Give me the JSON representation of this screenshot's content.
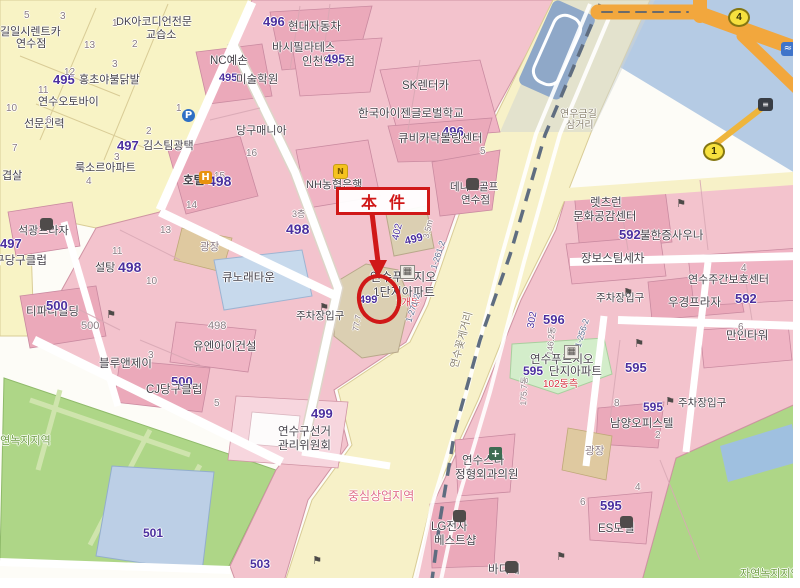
{
  "annotation": {
    "label": "本件"
  },
  "palette": {
    "purple": "#4b2f9e",
    "dark": "#46424a",
    "gray": "#8a7b82",
    "red": "#d83040",
    "zone": "#e0708a",
    "green": "#6f9c45",
    "road": "#8a8270",
    "code": "#5a6b8c",
    "annotation_red": "#d01818",
    "parcel_pink": "#f3c3cd",
    "parcel_yellow": "#f8f3c5",
    "road_yellow": "#f7f1c8",
    "water_blue": "#b5cbe4",
    "park_green": "#aed687",
    "orange_road": "#f2a73d"
  },
  "labels": [
    {
      "t": "길일시렌트카",
      "x": 0,
      "y": 27,
      "s": 11,
      "c": "dark"
    },
    {
      "t": "연수점",
      "x": 16,
      "y": 39,
      "s": 11,
      "c": "dark"
    },
    {
      "t": "DK아코디언전문",
      "x": 116,
      "y": 17,
      "s": 11,
      "c": "dark"
    },
    {
      "t": "교습소",
      "x": 146,
      "y": 30,
      "s": 11,
      "c": "dark"
    },
    {
      "t": "495",
      "x": 53,
      "y": 73,
      "s": 13,
      "c": "purple",
      "b": true
    },
    {
      "t": "홍초야불닭발",
      "x": 79,
      "y": 75,
      "s": 11,
      "c": "dark"
    },
    {
      "t": "연수오토바이",
      "x": 38,
      "y": 97,
      "s": 11,
      "c": "dark"
    },
    {
      "t": "선문전력",
      "x": 24,
      "y": 119,
      "s": 11,
      "c": "dark"
    },
    {
      "t": "겹살",
      "x": 2,
      "y": 171,
      "s": 11,
      "c": "dark"
    },
    {
      "t": "5",
      "x": 24,
      "y": 11,
      "s": 10,
      "c": "gray"
    },
    {
      "t": "3",
      "x": 60,
      "y": 12,
      "s": 10,
      "c": "gray"
    },
    {
      "t": "1",
      "x": 112,
      "y": 19,
      "s": 10,
      "c": "gray"
    },
    {
      "t": "13",
      "x": 84,
      "y": 41,
      "s": 10,
      "c": "gray"
    },
    {
      "t": "2",
      "x": 132,
      "y": 40,
      "s": 10,
      "c": "gray"
    },
    {
      "t": "3",
      "x": 112,
      "y": 60,
      "s": 10,
      "c": "gray"
    },
    {
      "t": "12",
      "x": 64,
      "y": 68,
      "s": 10,
      "c": "gray"
    },
    {
      "t": "11",
      "x": 38,
      "y": 86,
      "s": 10,
      "c": "gray"
    },
    {
      "t": "10",
      "x": 6,
      "y": 104,
      "s": 10,
      "c": "gray"
    },
    {
      "t": "6",
      "x": 46,
      "y": 116,
      "s": 10,
      "c": "gray"
    },
    {
      "t": "7",
      "x": 12,
      "y": 144,
      "s": 10,
      "c": "gray"
    },
    {
      "t": "496",
      "x": 263,
      "y": 15,
      "s": 13,
      "c": "purple",
      "b": true
    },
    {
      "t": "현대자동차",
      "x": 288,
      "y": 22,
      "s": 11.5,
      "c": "dark"
    },
    {
      "t": "바시필라테스",
      "x": 272,
      "y": 43,
      "s": 11.5,
      "c": "dark"
    },
    {
      "t": "인천연수점",
      "x": 302,
      "y": 57,
      "s": 11.5,
      "c": "dark"
    },
    {
      "t": "495",
      "x": 325,
      "y": 53,
      "s": 12,
      "c": "purple",
      "b": true
    },
    {
      "t": "NC예손",
      "x": 210,
      "y": 56,
      "s": 11.5,
      "c": "dark"
    },
    {
      "t": "495",
      "x": 219,
      "y": 73,
      "s": 11,
      "c": "purple",
      "b": true
    },
    {
      "t": "미술학원",
      "x": 236,
      "y": 75,
      "s": 11.5,
      "c": "dark"
    },
    {
      "t": "SK렌터카",
      "x": 402,
      "y": 81,
      "s": 11.5,
      "c": "dark"
    },
    {
      "t": "한국아이젠글로벌학교",
      "x": 358,
      "y": 109,
      "s": 11.5,
      "c": "dark"
    },
    {
      "t": "496",
      "x": 442,
      "y": 125,
      "s": 13,
      "c": "purple",
      "b": true
    },
    {
      "t": "큐비카락볼링센터",
      "x": 398,
      "y": 134,
      "s": 11.5,
      "c": "dark"
    },
    {
      "t": "5",
      "x": 480,
      "y": 147,
      "s": 10,
      "c": "gray"
    },
    {
      "t": "당구매니아",
      "x": 236,
      "y": 126,
      "s": 11,
      "c": "dark"
    },
    {
      "t": "16",
      "x": 246,
      "y": 149,
      "s": 10,
      "c": "gray"
    },
    {
      "t": "15",
      "x": 214,
      "y": 172,
      "s": 10,
      "c": "gray"
    },
    {
      "t": "호텔",
      "x": 183,
      "y": 176,
      "s": 11.5,
      "c": "dark",
      "b": true
    },
    {
      "t": "498",
      "x": 208,
      "y": 174,
      "s": 14,
      "c": "purple",
      "b": true
    },
    {
      "t": "497",
      "x": 117,
      "y": 139,
      "s": 13,
      "c": "purple",
      "b": true
    },
    {
      "t": "김스팀광택",
      "x": 143,
      "y": 141,
      "s": 11,
      "c": "dark"
    },
    {
      "t": "룩소르아파트",
      "x": 75,
      "y": 163,
      "s": 11,
      "c": "dark"
    },
    {
      "t": "1",
      "x": 176,
      "y": 104,
      "s": 10,
      "c": "gray"
    },
    {
      "t": "2",
      "x": 146,
      "y": 127,
      "s": 10,
      "c": "gray"
    },
    {
      "t": "3",
      "x": 114,
      "y": 153,
      "s": 10,
      "c": "gray"
    },
    {
      "t": "4",
      "x": 86,
      "y": 177,
      "s": 10,
      "c": "gray"
    },
    {
      "t": "NH농협은행",
      "x": 306,
      "y": 180,
      "s": 11,
      "c": "dark"
    },
    {
      "t": "데니스골프",
      "x": 450,
      "y": 182,
      "s": 10.5,
      "c": "dark"
    },
    {
      "t": "연수점",
      "x": 461,
      "y": 195,
      "s": 10.5,
      "c": "dark"
    },
    {
      "t": "3층",
      "x": 292,
      "y": 210,
      "s": 9,
      "c": "gray"
    },
    {
      "t": "498",
      "x": 286,
      "y": 222,
      "s": 14,
      "c": "purple",
      "b": true
    },
    {
      "t": "광장",
      "x": 200,
      "y": 242,
      "s": 10.5,
      "c": "gray"
    },
    {
      "t": "큐노래타운",
      "x": 222,
      "y": 273,
      "s": 11.5,
      "c": "dark"
    },
    {
      "t": "주차장입구",
      "x": 296,
      "y": 311,
      "s": 10.5,
      "c": "dark"
    },
    {
      "t": "연수푸르지오",
      "x": 370,
      "y": 271,
      "s": 12,
      "c": "dark"
    },
    {
      "t": "1단지아파트",
      "x": 373,
      "y": 286,
      "s": 12,
      "c": "dark"
    },
    {
      "t": "1개동",
      "x": 396,
      "y": 299,
      "s": 10,
      "c": "red"
    },
    {
      "t": "499",
      "x": 359,
      "y": 295,
      "s": 11,
      "c": "purple",
      "b": true
    },
    {
      "t": "77.7",
      "x": 357,
      "y": 323,
      "s": 8.5,
      "c": "gray",
      "r": -80
    },
    {
      "t": "402",
      "x": 398,
      "y": 232,
      "s": 10,
      "c": "purple",
      "r": -77
    },
    {
      "t": "499",
      "x": 414,
      "y": 240,
      "s": 11,
      "c": "purple",
      "b": true,
      "r": -15
    },
    {
      "t": "3.5m",
      "x": 428,
      "y": 229,
      "s": 8.5,
      "c": "gray",
      "r": -77
    },
    {
      "t": "1-261-2",
      "x": 438,
      "y": 255,
      "s": 8.5,
      "c": "code",
      "r": -72
    },
    {
      "t": "1-271-2",
      "x": 413,
      "y": 308,
      "s": 8.5,
      "c": "code",
      "r": -72
    },
    {
      "t": "연수꽃게거리",
      "x": 462,
      "y": 340,
      "s": 10.5,
      "c": "road",
      "r": -75
    },
    {
      "t": "연우금길",
      "x": 560,
      "y": 110,
      "s": 10,
      "c": "road"
    },
    {
      "t": "삼거리",
      "x": 566,
      "y": 121,
      "s": 10,
      "c": "road"
    },
    {
      "t": "석광프라자",
      "x": 18,
      "y": 226,
      "s": 11,
      "c": "dark"
    },
    {
      "t": "497",
      "x": 0,
      "y": 237,
      "s": 13,
      "c": "purple",
      "b": true
    },
    {
      "t": "구당구클럽",
      "x": -6,
      "y": 256,
      "s": 11.5,
      "c": "dark"
    },
    {
      "t": "설탕",
      "x": 95,
      "y": 263,
      "s": 11,
      "c": "dark"
    },
    {
      "t": "498",
      "x": 118,
      "y": 260,
      "s": 14,
      "c": "purple",
      "b": true
    },
    {
      "t": "11",
      "x": 112,
      "y": 247,
      "s": 10,
      "c": "gray"
    },
    {
      "t": "10",
      "x": 146,
      "y": 277,
      "s": 10,
      "c": "gray"
    },
    {
      "t": "13",
      "x": 160,
      "y": 226,
      "s": 10,
      "c": "gray"
    },
    {
      "t": "14",
      "x": 186,
      "y": 201,
      "s": 10,
      "c": "gray"
    },
    {
      "t": "티파니빌딩",
      "x": 26,
      "y": 307,
      "s": 11.5,
      "c": "dark"
    },
    {
      "t": "500",
      "x": 46,
      "y": 299,
      "s": 13,
      "c": "purple",
      "b": true
    },
    {
      "t": "500",
      "x": 81,
      "y": 321,
      "s": 11,
      "c": "gray"
    },
    {
      "t": "498",
      "x": 208,
      "y": 321,
      "s": 11,
      "c": "gray"
    },
    {
      "t": "유엔아이건설",
      "x": 193,
      "y": 342,
      "s": 11.5,
      "c": "dark"
    },
    {
      "t": "블루앤제이",
      "x": 99,
      "y": 359,
      "s": 11.5,
      "c": "dark"
    },
    {
      "t": "3",
      "x": 148,
      "y": 351,
      "s": 10,
      "c": "gray"
    },
    {
      "t": "500",
      "x": 171,
      "y": 375,
      "s": 13,
      "c": "purple",
      "b": true
    },
    {
      "t": "CJ당구클럽",
      "x": 146,
      "y": 385,
      "s": 11.5,
      "c": "dark"
    },
    {
      "t": "5",
      "x": 214,
      "y": 399,
      "s": 10,
      "c": "gray"
    },
    {
      "t": "자연녹지지역",
      "x": -10,
      "y": 436,
      "s": 11,
      "c": "green"
    },
    {
      "t": "501",
      "x": 143,
      "y": 527,
      "s": 12,
      "c": "purple",
      "b": true
    },
    {
      "t": "503",
      "x": 250,
      "y": 558,
      "s": 12,
      "c": "purple",
      "b": true
    },
    {
      "t": "499",
      "x": 311,
      "y": 407,
      "s": 13,
      "c": "purple",
      "b": true
    },
    {
      "t": "연수구선거",
      "x": 278,
      "y": 427,
      "s": 11.5,
      "c": "dark"
    },
    {
      "t": "관리위원회",
      "x": 278,
      "y": 441,
      "s": 11.5,
      "c": "dark"
    },
    {
      "t": "중심상업지역",
      "x": 348,
      "y": 490,
      "s": 12,
      "c": "zone"
    },
    {
      "t": "렛츠런",
      "x": 590,
      "y": 198,
      "s": 11.5,
      "c": "dark"
    },
    {
      "t": "문화공감센터",
      "x": 573,
      "y": 212,
      "s": 11.5,
      "c": "dark"
    },
    {
      "t": "592",
      "x": 619,
      "y": 228,
      "s": 13,
      "c": "purple",
      "b": true
    },
    {
      "t": "불한증사우나",
      "x": 640,
      "y": 231,
      "s": 11.5,
      "c": "dark"
    },
    {
      "t": "장보스팀세차",
      "x": 581,
      "y": 254,
      "s": 11.5,
      "c": "dark"
    },
    {
      "t": "주차장입구",
      "x": 596,
      "y": 293,
      "s": 10.5,
      "c": "dark"
    },
    {
      "t": "연수주간보호센터",
      "x": 688,
      "y": 275,
      "s": 11,
      "c": "dark"
    },
    {
      "t": "4",
      "x": 741,
      "y": 264,
      "s": 10,
      "c": "gray"
    },
    {
      "t": "592",
      "x": 735,
      "y": 292,
      "s": 13,
      "c": "purple",
      "b": true
    },
    {
      "t": "우경프라자",
      "x": 668,
      "y": 298,
      "s": 11.5,
      "c": "dark"
    },
    {
      "t": "만인타워",
      "x": 726,
      "y": 331,
      "s": 11.5,
      "c": "dark"
    },
    {
      "t": "6",
      "x": 738,
      "y": 323,
      "s": 10,
      "c": "gray"
    },
    {
      "t": "596",
      "x": 543,
      "y": 313,
      "s": 13,
      "c": "purple",
      "b": true
    },
    {
      "t": "302",
      "x": 533,
      "y": 320,
      "s": 10,
      "c": "purple",
      "r": -80
    },
    {
      "t": "146.2동",
      "x": 551,
      "y": 341,
      "s": 8.5,
      "c": "gray",
      "r": -85
    },
    {
      "t": "1-256-2",
      "x": 582,
      "y": 333,
      "s": 8.5,
      "c": "code",
      "r": -73
    },
    {
      "t": "연수푸르지오",
      "x": 530,
      "y": 355,
      "s": 11.5,
      "c": "dark"
    },
    {
      "t": "595",
      "x": 523,
      "y": 365,
      "s": 12,
      "c": "purple",
      "b": true
    },
    {
      "t": "단지아파트",
      "x": 549,
      "y": 367,
      "s": 11.5,
      "c": "dark"
    },
    {
      "t": "102동측",
      "x": 543,
      "y": 380,
      "s": 10,
      "c": "red"
    },
    {
      "t": "175.7동",
      "x": 524,
      "y": 391,
      "s": 8.5,
      "c": "gray",
      "r": -87
    },
    {
      "t": "595",
      "x": 625,
      "y": 361,
      "s": 13,
      "c": "purple",
      "b": true
    },
    {
      "t": "주차장입구",
      "x": 678,
      "y": 398,
      "s": 10.5,
      "c": "dark"
    },
    {
      "t": "8",
      "x": 614,
      "y": 399,
      "s": 10,
      "c": "gray"
    },
    {
      "t": "595",
      "x": 643,
      "y": 401,
      "s": 12,
      "c": "purple",
      "b": true
    },
    {
      "t": "남양오피스텔",
      "x": 610,
      "y": 419,
      "s": 11.5,
      "c": "dark"
    },
    {
      "t": "2",
      "x": 655,
      "y": 431,
      "s": 10,
      "c": "gray"
    },
    {
      "t": "광장",
      "x": 585,
      "y": 446,
      "s": 10.5,
      "c": "gray"
    },
    {
      "t": "4",
      "x": 635,
      "y": 483,
      "s": 10,
      "c": "gray"
    },
    {
      "t": "6",
      "x": 580,
      "y": 498,
      "s": 10,
      "c": "gray"
    },
    {
      "t": "595",
      "x": 600,
      "y": 499,
      "s": 13,
      "c": "purple",
      "b": true
    },
    {
      "t": "ES모텔",
      "x": 598,
      "y": 524,
      "s": 11.5,
      "c": "dark"
    },
    {
      "t": "연수스타",
      "x": 462,
      "y": 456,
      "s": 11.5,
      "c": "dark"
    },
    {
      "t": "정형외과의원",
      "x": 455,
      "y": 470,
      "s": 11.5,
      "c": "dark"
    },
    {
      "t": "LG전자",
      "x": 431,
      "y": 522,
      "s": 11.5,
      "c": "dark"
    },
    {
      "t": "베스트샵",
      "x": 434,
      "y": 536,
      "s": 11.5,
      "c": "dark"
    },
    {
      "t": "바디셰",
      "x": 488,
      "y": 565,
      "s": 11.5,
      "c": "dark"
    },
    {
      "t": "자연녹지지역",
      "x": 740,
      "y": 569,
      "s": 11,
      "c": "green"
    }
  ],
  "icons": [
    {
      "n": "parking-sign-icon",
      "k": "psign",
      "g": "P",
      "x": 182,
      "y": 109
    },
    {
      "n": "hotel-icon",
      "k": "hotel",
      "g": "H",
      "x": 199,
      "y": 171
    },
    {
      "n": "nh-bank-icon",
      "k": "bank",
      "g": "N",
      "x": 333,
      "y": 164
    },
    {
      "n": "golf-shop-icon",
      "k": "dark",
      "g": "",
      "x": 466,
      "y": 178
    },
    {
      "n": "apartment-icon",
      "k": "apt",
      "g": "▦",
      "x": 400,
      "y": 265
    },
    {
      "n": "apartment-icon",
      "k": "apt",
      "g": "▦",
      "x": 564,
      "y": 345
    },
    {
      "n": "hospital-cross-icon",
      "k": "cross",
      "g": "+",
      "x": 489,
      "y": 447
    },
    {
      "n": "store-bag-icon",
      "k": "dark",
      "g": "",
      "x": 453,
      "y": 510
    },
    {
      "n": "store-bag-icon",
      "k": "dark",
      "g": "",
      "x": 505,
      "y": 561
    },
    {
      "n": "motel-icon",
      "k": "dark",
      "g": "",
      "x": 620,
      "y": 516
    },
    {
      "n": "plaza-icon",
      "k": "dark",
      "g": "",
      "x": 40,
      "y": 218
    },
    {
      "n": "parking-entrance-flag-icon",
      "k": "flag",
      "g": "⚑",
      "x": 318,
      "y": 301
    },
    {
      "n": "parking-entrance-flag-icon",
      "k": "flag",
      "g": "⚑",
      "x": 105,
      "y": 308
    },
    {
      "n": "parking-entrance-flag-icon",
      "k": "flag",
      "g": "⚑",
      "x": 622,
      "y": 286
    },
    {
      "n": "parking-entrance-flag-icon",
      "k": "flag",
      "g": "⚑",
      "x": 675,
      "y": 197
    },
    {
      "n": "parking-entrance-flag-icon",
      "k": "flag",
      "g": "⚑",
      "x": 633,
      "y": 337
    },
    {
      "n": "parking-entrance-flag-icon",
      "k": "flag",
      "g": "⚑",
      "x": 664,
      "y": 395
    },
    {
      "n": "parking-entrance-flag-icon",
      "k": "flag",
      "g": "⚑",
      "x": 311,
      "y": 554
    },
    {
      "n": "parking-entrance-flag-icon",
      "k": "flag",
      "g": "⚑",
      "x": 555,
      "y": 550
    },
    {
      "n": "bus-stop-icon",
      "k": "bus",
      "g": "≡",
      "x": 758,
      "y": 98
    },
    {
      "n": "pool-icon",
      "k": "pool",
      "g": "≈",
      "x": 781,
      "y": 42
    }
  ],
  "badges": [
    {
      "n": "4",
      "x": 728,
      "y": 8
    },
    {
      "n": "1",
      "x": 703,
      "y": 142
    }
  ]
}
